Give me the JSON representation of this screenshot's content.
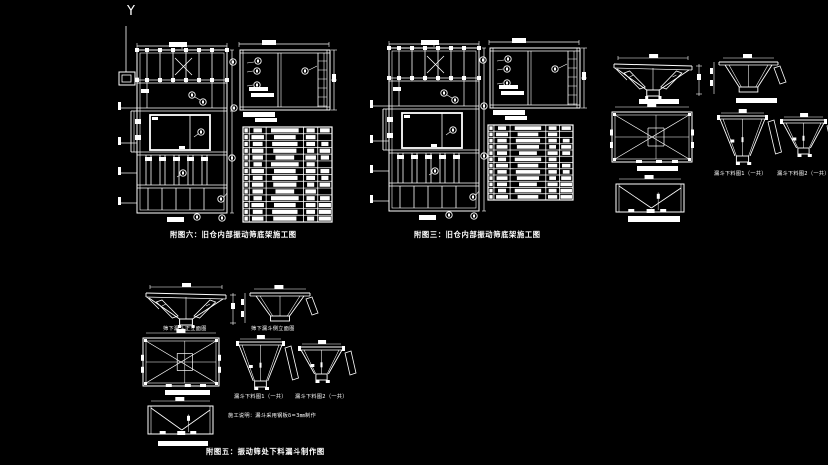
{
  "colors": {
    "background": "#000000",
    "line": "#ffffff"
  },
  "ucs": {
    "axis_label": "Y"
  },
  "fig6": {
    "caption": "附图六：旧仓内部振动筛底架施工图",
    "parts_table_rows": 14
  },
  "fig3": {
    "caption": "附图三：旧仓内部振动筛底架施工图",
    "parts_table_rows": 12
  },
  "fig5": {
    "caption": "附图五：振动筛处下料漏斗制作图",
    "front_view_label": "筛下漏斗正立面图",
    "side_view_label": "筛下漏斗侧立面图",
    "blank1_label": "漏斗下料图1（一共）",
    "blank2_label": "漏斗下料图2（一共）",
    "note": "施工说明：漏斗采用钢板δ=3㎜制作"
  },
  "hopper_set": {
    "blank1_label": "漏斗下料图1（一共）",
    "blank2_label": "漏斗下料图2（一共）"
  },
  "parts_table_columns": 5
}
